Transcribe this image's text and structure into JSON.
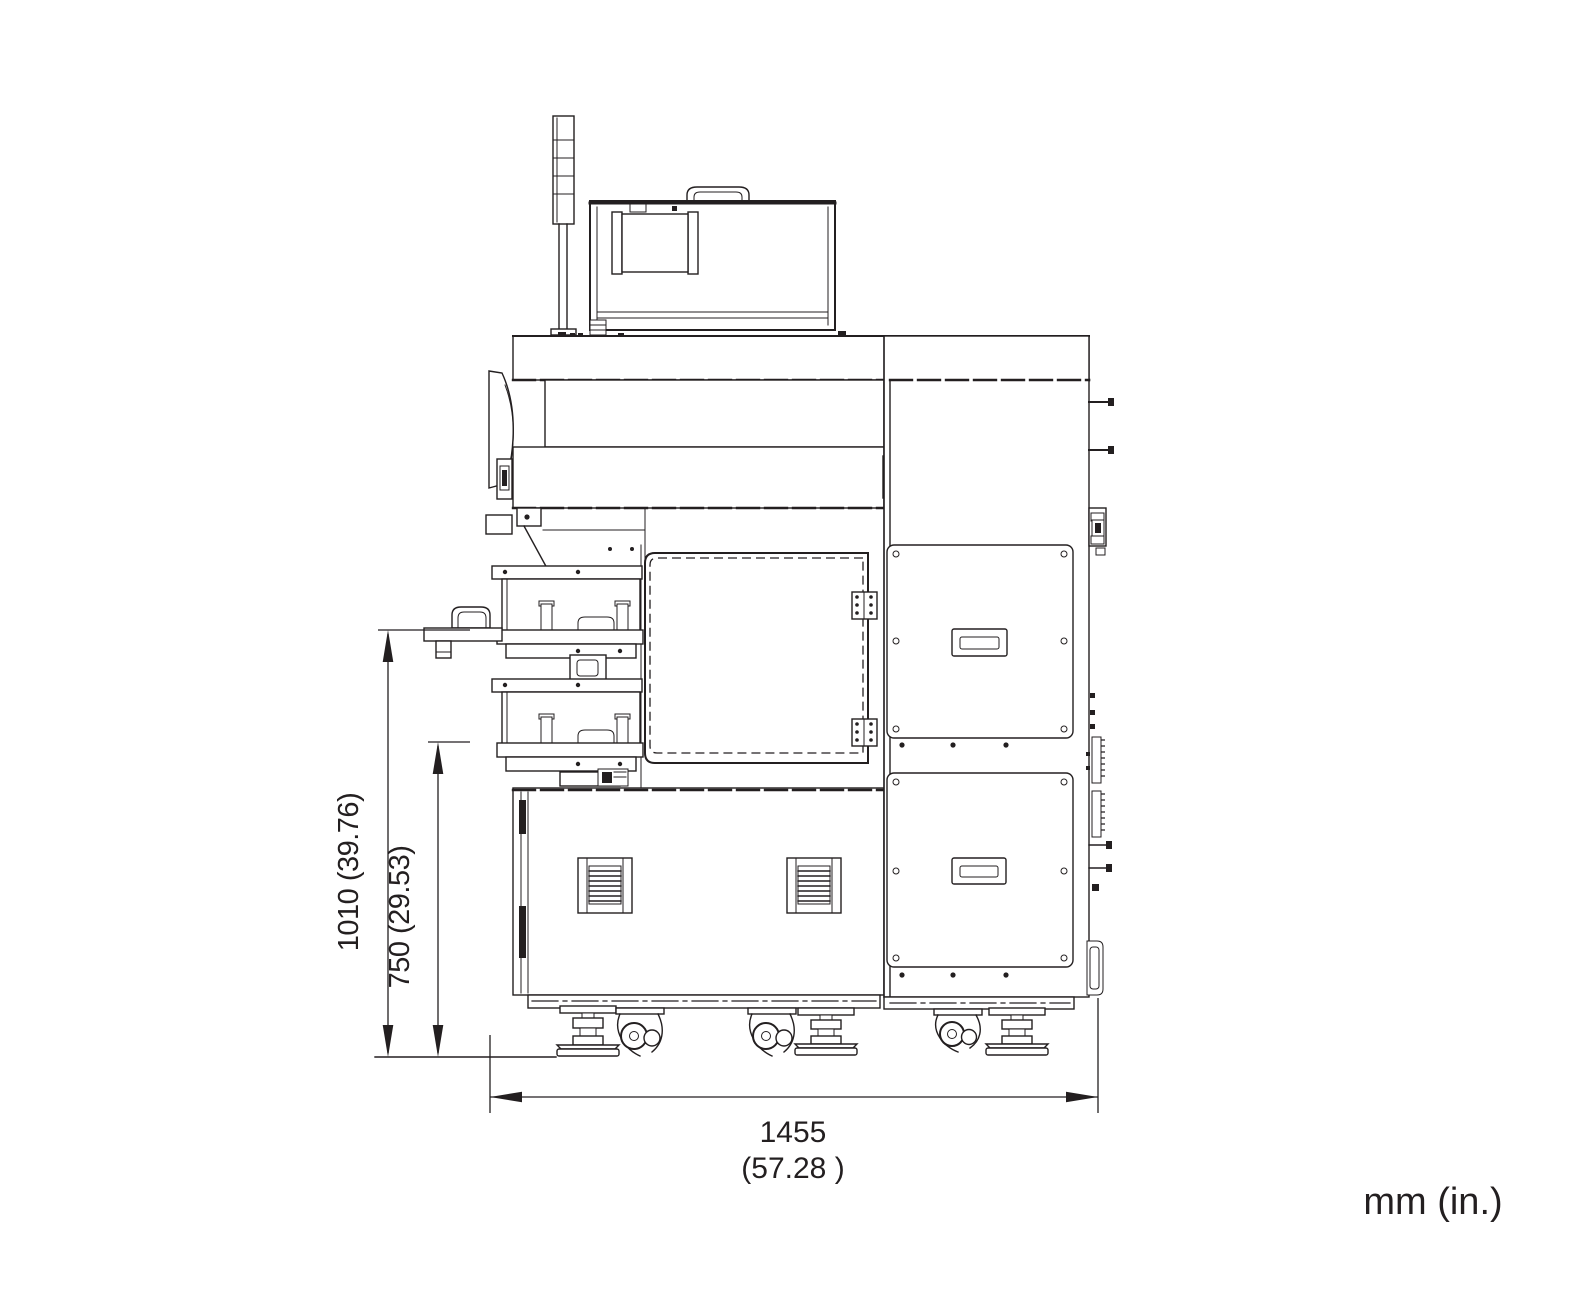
{
  "colors": {
    "ink": "#231f20",
    "background": "#ffffff"
  },
  "dimensions": {
    "overall_height_label": "1010 (39.76)",
    "intermediate_height_label": "750 (29.53)",
    "overall_width_mm": "1455",
    "overall_width_in": "(57.28 )"
  },
  "units_note": "mm (in.)"
}
